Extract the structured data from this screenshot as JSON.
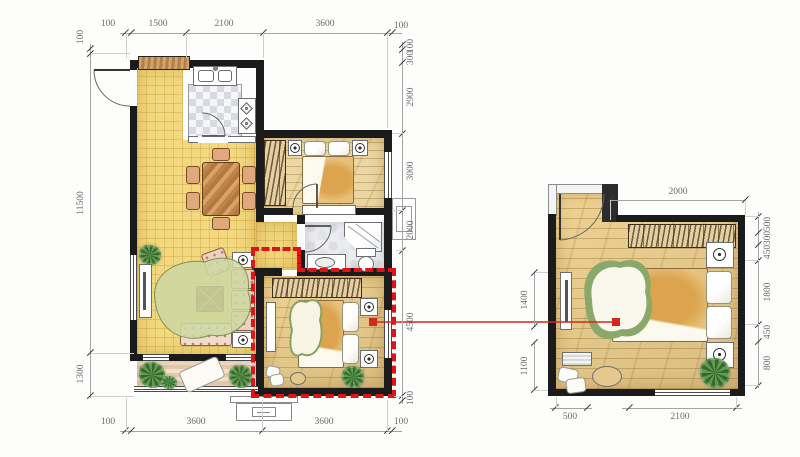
{
  "drawing": {
    "type": "apartment-floor-plan-with-bedroom-detail",
    "colors": {
      "wall": "#1b1b1b",
      "highlight_red": "#e01414",
      "leader_red": "#cf2a1b",
      "dim_line": "#a4a4a4",
      "dim_text": "#6b6b6b",
      "floor_tile_yellow": "#f2d87e",
      "floor_wood_tan": "#ead7a4",
      "floor_stone_gray": "#ebecef",
      "balcony_stripe": "#e5cbad"
    }
  },
  "main_plan": {
    "dims_top": [
      "100",
      "1500",
      "2100",
      "3600",
      "100"
    ],
    "dims_bottom": [
      "100",
      "3600",
      "3600",
      "100"
    ],
    "dims_left": [
      "100",
      "11500",
      "1300"
    ],
    "dims_right": [
      "100",
      "300",
      "2900",
      "3000",
      "2000",
      "4500",
      "100"
    ]
  },
  "detail_plan": {
    "dims_top": [
      "2000"
    ],
    "dims_left": [
      "1400",
      "1100"
    ],
    "dims_right": [
      "500",
      "300",
      "450",
      "1800",
      "450",
      "800"
    ],
    "dims_bottom": [
      "500",
      "2100"
    ]
  }
}
